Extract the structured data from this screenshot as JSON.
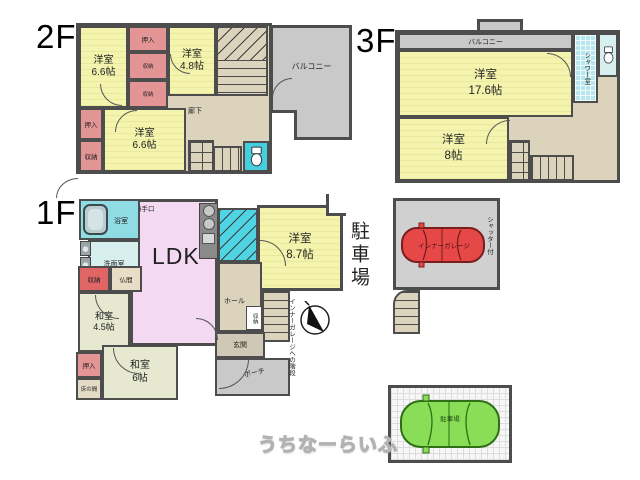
{
  "watermark": "うちなーらいふ",
  "palette": {
    "wall": "#4d4d4d",
    "western_room_yellow": "#f4f4ae",
    "closet_pink": "#e39595",
    "storage_red": "#e06565",
    "hall_beige": "#dcd3bd",
    "tatami_green": "#e6e9d0",
    "ldk_pink": "#f3d9f1",
    "water_cyan": "#45cede",
    "balcony_gray": "#c9c9c9",
    "car_red": "#e64848",
    "car_green": "#8ade57"
  },
  "f2": {
    "floor_label": "2F",
    "yoshitsu_a": {
      "name": "洋室",
      "size": "6.6帖"
    },
    "yoshitsu_b": {
      "name": "洋室",
      "size": "4.8帖"
    },
    "yoshitsu_c": {
      "name": "洋室",
      "size": "6.6帖"
    },
    "oshiire_top": "押入",
    "shuno_a": "収納",
    "shuno_b": "収納",
    "oshiire_left": "押入",
    "shuno_left": "収納",
    "roka": "廊下",
    "balcony": "バルコニー"
  },
  "f3": {
    "floor_label": "3F",
    "balcony": "バルコニー",
    "shower": "シャワー室",
    "yoshitsu_a": {
      "name": "洋室",
      "size": "17.6帖"
    },
    "yoshitsu_b": {
      "name": "洋室",
      "size": "8帖"
    }
  },
  "f1": {
    "floor_label": "1F",
    "bath": "浴室",
    "katteguchi": "勝手口",
    "senmen": "洗面室",
    "shuno": "収納",
    "butsuma": "仏間",
    "washitsu_a": {
      "name": "和室",
      "size": "4.5帖"
    },
    "oshiire": "押入",
    "tokonoma": "床の間",
    "washitsu_b": {
      "name": "和室",
      "size": "6帖"
    },
    "ldk": "LDK",
    "hall": "ホール",
    "shuno_small": "収納",
    "genkan": "玄関",
    "porch": "ポーチ",
    "garage_stairs_note": "インナーガレージへの階段",
    "yoshitsu": {
      "name": "洋室",
      "size": "8.7帖"
    },
    "parking_label": "駐車場"
  },
  "garage": {
    "label": "インナーガレージ",
    "shutter": "シャッター付"
  },
  "parking": {
    "label": "駐車場"
  }
}
